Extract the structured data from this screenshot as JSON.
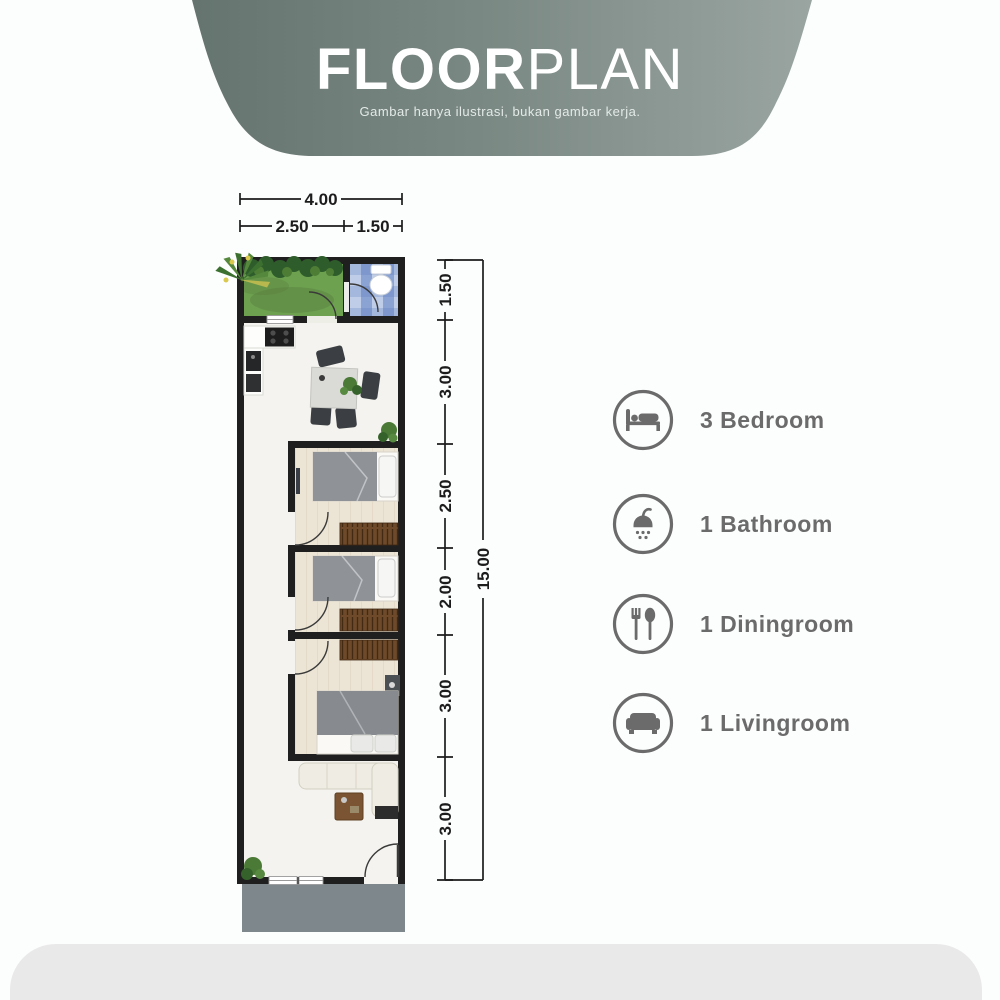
{
  "header": {
    "title_bold": "FLOOR",
    "title_light": "PLAN",
    "subtitle": "Gambar hanya ilustrasi, bukan gambar kerja."
  },
  "plan": {
    "dims": {
      "top_total": "4.00",
      "top_left": "2.50",
      "top_right": "1.50",
      "right_total": "15.00",
      "right_segments": [
        "1.50",
        "3.00",
        "2.50",
        "2.00",
        "3.00",
        "3.00"
      ]
    }
  },
  "legend": {
    "items": [
      {
        "icon": "bed-icon",
        "label": "3 Bedroom"
      },
      {
        "icon": "shower-icon",
        "label": "1 Bathroom"
      },
      {
        "icon": "cutlery-icon",
        "label": "1 Diningroom"
      },
      {
        "icon": "sofa-icon",
        "label": "1 Livingroom"
      }
    ]
  },
  "colors": {
    "page": "#fcfdfd",
    "banner_a": "#65746f",
    "banner_b": "#7c8a85",
    "banner_c": "#9aa5a1",
    "wall": "#1f1f1f",
    "grass": "#6da150",
    "bush": "#2f5c2b",
    "floor1": "#f4f3ef",
    "wardrobe": "#6f4a2a",
    "blanket": "#8f9398",
    "sofa": "#efece4",
    "chair": "#3b3f43",
    "ctable": "#7b5533",
    "porch": "#7e878c",
    "footer": "#e9e9e9",
    "dim": "#1c1c1c",
    "legend": "#6b6b6b",
    "doorarc": "#3a3a3a"
  }
}
